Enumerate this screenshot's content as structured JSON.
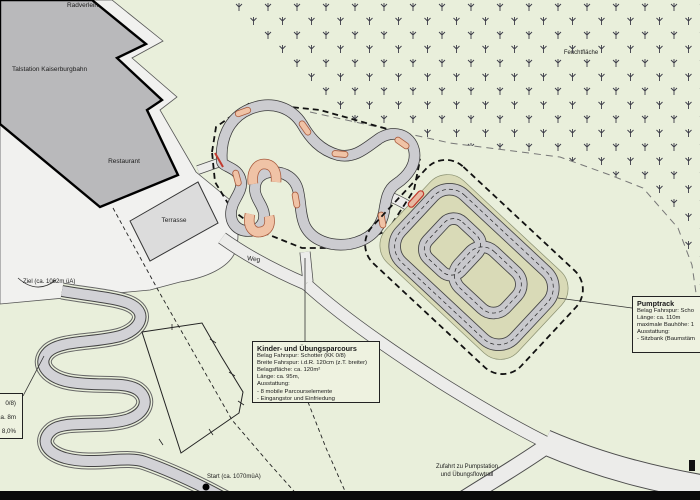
{
  "map": {
    "area_labels": {
      "radverleih": "Radverleih",
      "talstation": "Talstation Kaiserburgbahn",
      "restaurant": "Restaurant",
      "terrasse": "Terrasse",
      "weg": "Weg",
      "feuchtflaeche": "Feuchtfläche",
      "ziel": "Ziel (ca. 1062m üA)",
      "start": "Start (ca. 1070müA)",
      "zufahrt_line1": "Zufahrt zu Pumpstation",
      "zufahrt_line2": "und Übungsflowtrail"
    },
    "boxes": {
      "kinder": {
        "title": "Kinder- und Übungsparcours",
        "lines": [
          "Belag Fahrspur: Schotter (KK 0/8)",
          "Breite Fahrspur: i.d.R. 120cm (z.T. breiter)",
          "Belagsfläche: ca. 120m²",
          "Länge: ca. 95m,",
          "Ausstattung:",
          "- 8 mobile Parcourselemente",
          "- Eingangstor und Einfriedung"
        ]
      },
      "pumptrack": {
        "title": "Pumptrack",
        "lines": [
          "Belag Fahrspur: Scho",
          "Länge: ca. 110m",
          "maximale Bauhöhe: 1",
          "Ausstattung:",
          "- Sitzbank (Baumstäm"
        ]
      },
      "flowtrail": {
        "lines": [
          "0/8)",
          "ca. 8m",
          "a. 8,0%"
        ]
      }
    },
    "colors": {
      "grass": "#e9efdb",
      "plaza": "#f1f1ef",
      "building": "#b9b9bb",
      "terrace": "#dcdcdc",
      "path_fill": "#ececea",
      "path_edge": "#4c4c4c",
      "track_fill": "#c8c8cc",
      "berm_fill": "#f0c3a6",
      "berm_outline": "#a85a3c",
      "mound": "#d9dab7",
      "marsh_symbol": "#3c3c48",
      "boundary_dash": "#111111",
      "wetland_dash": "#777777"
    },
    "icons": {
      "start_point": "start-point-dot",
      "marsh": "marsh-symbol"
    }
  }
}
